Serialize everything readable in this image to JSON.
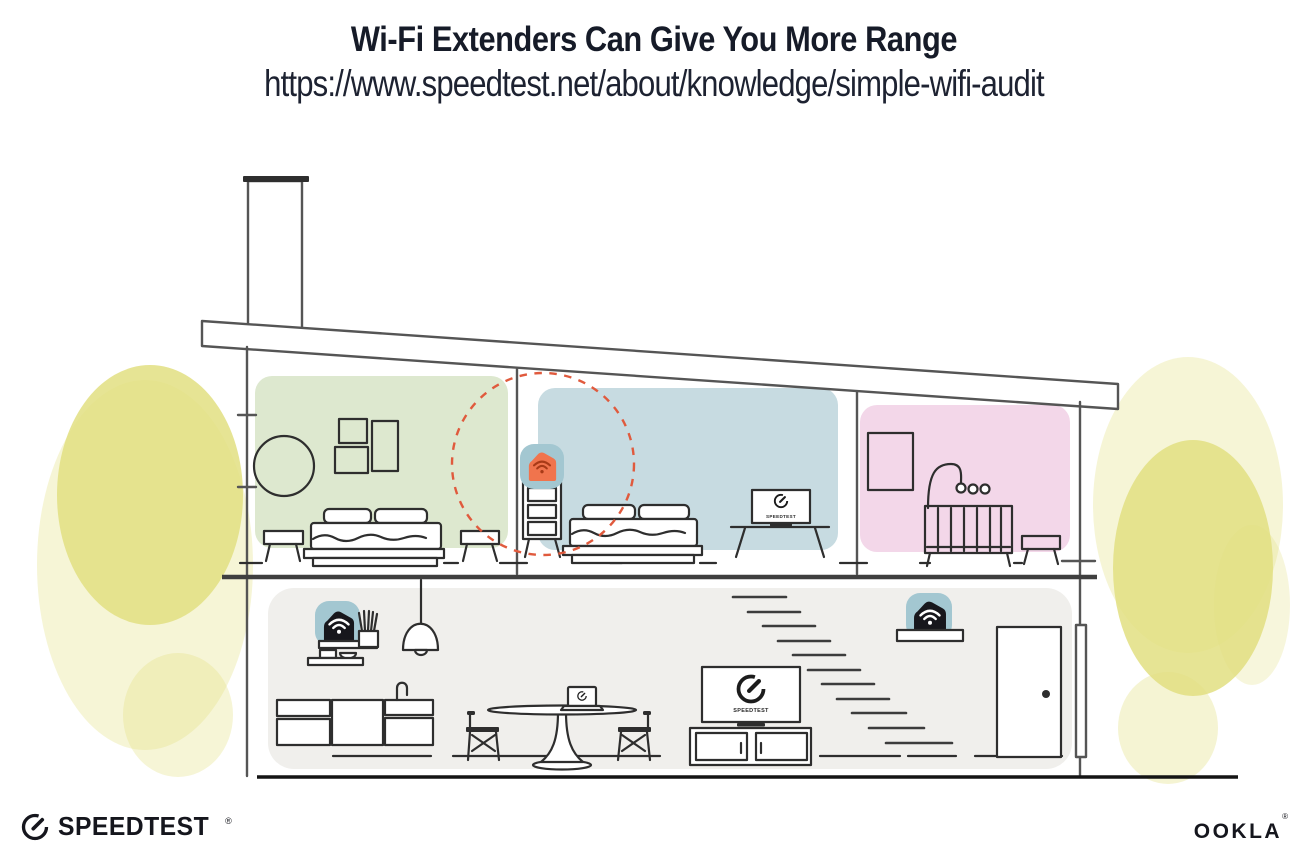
{
  "header": {
    "title": "Wi-Fi Extenders Can Give You More Range",
    "url": "https://www.speedtest.net/about/knowledge/simple-wifi-audit"
  },
  "illustration": {
    "tv_label": "SPEEDTEST",
    "icons": {
      "bedroom_extender": "wifi-extender-marker",
      "kitchen_router": "wifi-router-marker",
      "hall_extender": "wifi-extender-marker",
      "tv_screens": "speedtest-gauge",
      "coverage": "extender-range-dashed-circle"
    }
  },
  "footer": {
    "speedtest_wordmark": "SPEEDTEST",
    "speedtest_reg": "®",
    "ookla_wordmark": "OOKLA",
    "ookla_reg": "®"
  },
  "colors": {
    "title_ink": "#161b28",
    "ink": "#2e2e2e",
    "wall": "#555555",
    "room_green": "#dde8cf",
    "room_blue": "#c7dbe1",
    "room_pink": "#f3d7e9",
    "floor_gray": "#f0efec",
    "device_teal": "#a3c7d1",
    "device_black": "#17171c",
    "accent_orange": "#f0744d",
    "accent_orange_dark": "#a83a17",
    "dashed_red": "#e05a3d",
    "foliage": "#e2df81"
  }
}
